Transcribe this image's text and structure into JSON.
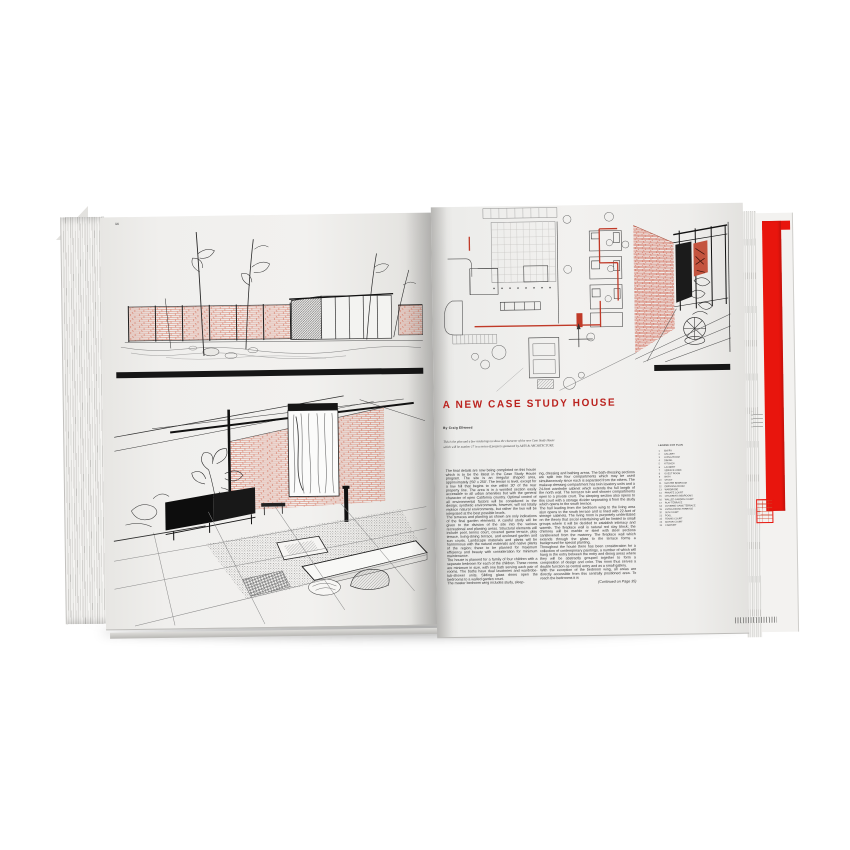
{
  "book": {
    "colors": {
      "title_red": "#bb231f",
      "cover_red": "#e8150d",
      "brick_red": "#d4705a",
      "plan_red": "#c03a28",
      "rule_black": "#161616"
    },
    "left_page": {
      "page_number": "14"
    },
    "right_page": {
      "title": "A NEW CASE STUDY HOUSE",
      "byline": "By Craig Ellwood",
      "intro": "This is the plan and a few renderings to show the character of the new Case Study House which will be number 17 in a series of projects sponsored by ARTS & ARCHITECTURE.",
      "columns": [
        {
          "text": "The final details are now being completed on this house which is to be the latest in the Case Study House program. The site is an irregular shaped area, approximately 250' x 250'. The terrain is level, except for a low hill that begins to rise within 30' of the rear property line. The area is in a wooded section easily accessible to all urban amenities but with the general character of open California country. Optimal control of all environmental factors will be considered in the design; synthetic environments, however, will not totally replace natural environments, but rather the two will be integrated at the best possible levels.\nThe terraces and planting as shown are only indications of the final garden elements. A careful study will be given to the division of the site into the various recreational and planting areas. Structural elements will include pool, tennis court, covered game terrace, play terrace, living-dining terrace, and enclosed garden and sun courts. Landscape materials and plants will be harmonious with the natural materials and native plants of the region; these to be planned for maximum efficiency and beauty with consideration for minimum maintenance.\nThe house is planned for a family of four children with a separate bedroom for each of the children. These rooms are minimum in size, with one bath serving each pair of rooms. The baths have dual lavatories and wardrobe-tub-shower units. Sliding glass doors open the bedrooms to a walled garden court.\nThe master bedroom wing includes study, sleep-"
        },
        {
          "text": "ing, dressing and bathing areas. The bath-dressing sections are split into four compartments which may be used simultaneously since each is separated from the others. The makeup dressing compartment has twin lavatory units and a 24-foot wardrobe cabinet which extends the full length of the north wall. The terrazzo tub and shower compartments open to a private court. The sleeping section also opens to this court with a storage divider separating it from the study which opens to the south terrace.\nThe hall leading from the bedroom wing to the living area also opens to the south terrace and is lined with 22-feet of storage cabinets. The living room is purposely understated on the theory that social entertaining will be limited to small groups where it will be decided to establish intimacy and warmth. The fireplace wall is natural red clay block; the chimney will be marble or steel with steel sections cantilevered from the masonry. The fireplace wall which extends through the glass to the terrace forms a background for special planting.\nThroughout the house there has been consideration for a collection of contemporary paintings, a number of which will hang in the entry between the entry and dining areas where they will be abstractly grouped together to form a composition of design and color. This room thus serves a double function as central entry and as a small gallery.\nWith the exception of the bedroom wing, all areas are directly accessible from this centrally positioned area. To reach the bedrooms it is"
        }
      ],
      "continued_note": "(Continued on Page 35)",
      "legend": {
        "header": "LEGEND FOR PLAN",
        "items": [
          {
            "n": "1",
            "label": "ENTRY"
          },
          {
            "n": "2",
            "label": "GALLERY"
          },
          {
            "n": "3",
            "label": "LIVING ROOM"
          },
          {
            "n": "4",
            "label": "DINING"
          },
          {
            "n": "5",
            "label": "KITCHEN"
          },
          {
            "n": "6",
            "label": "LAUNDRY"
          },
          {
            "n": "7",
            "label": "SERVICE YARD"
          },
          {
            "n": "8",
            "label": "GUEST ROOM"
          },
          {
            "n": "9",
            "label": "BATH"
          },
          {
            "n": "10",
            "label": "STUDY"
          },
          {
            "n": "11",
            "label": "MASTER BEDROOM"
          },
          {
            "n": "12",
            "label": "DRESSING ROOM"
          },
          {
            "n": "13",
            "label": "WARDROBE"
          },
          {
            "n": "14",
            "label": "PRIVATE COURT"
          },
          {
            "n": "15",
            "label": "CHILDREN'S BEDROOMS"
          },
          {
            "n": "16",
            "label": "WALLED GARDEN COURT"
          },
          {
            "n": "17",
            "label": "PLAY TERRACE"
          },
          {
            "n": "18",
            "label": "COVERED GAME TERRACE"
          },
          {
            "n": "19",
            "label": "LIVING-DINING TERRACE"
          },
          {
            "n": "20",
            "label": "SUN COURT"
          },
          {
            "n": "21",
            "label": "POOL"
          },
          {
            "n": "22",
            "label": "TENNIS COURT"
          },
          {
            "n": "23",
            "label": "MOTOR COURT"
          },
          {
            "n": "24",
            "label": "CARPORT"
          }
        ]
      }
    }
  }
}
